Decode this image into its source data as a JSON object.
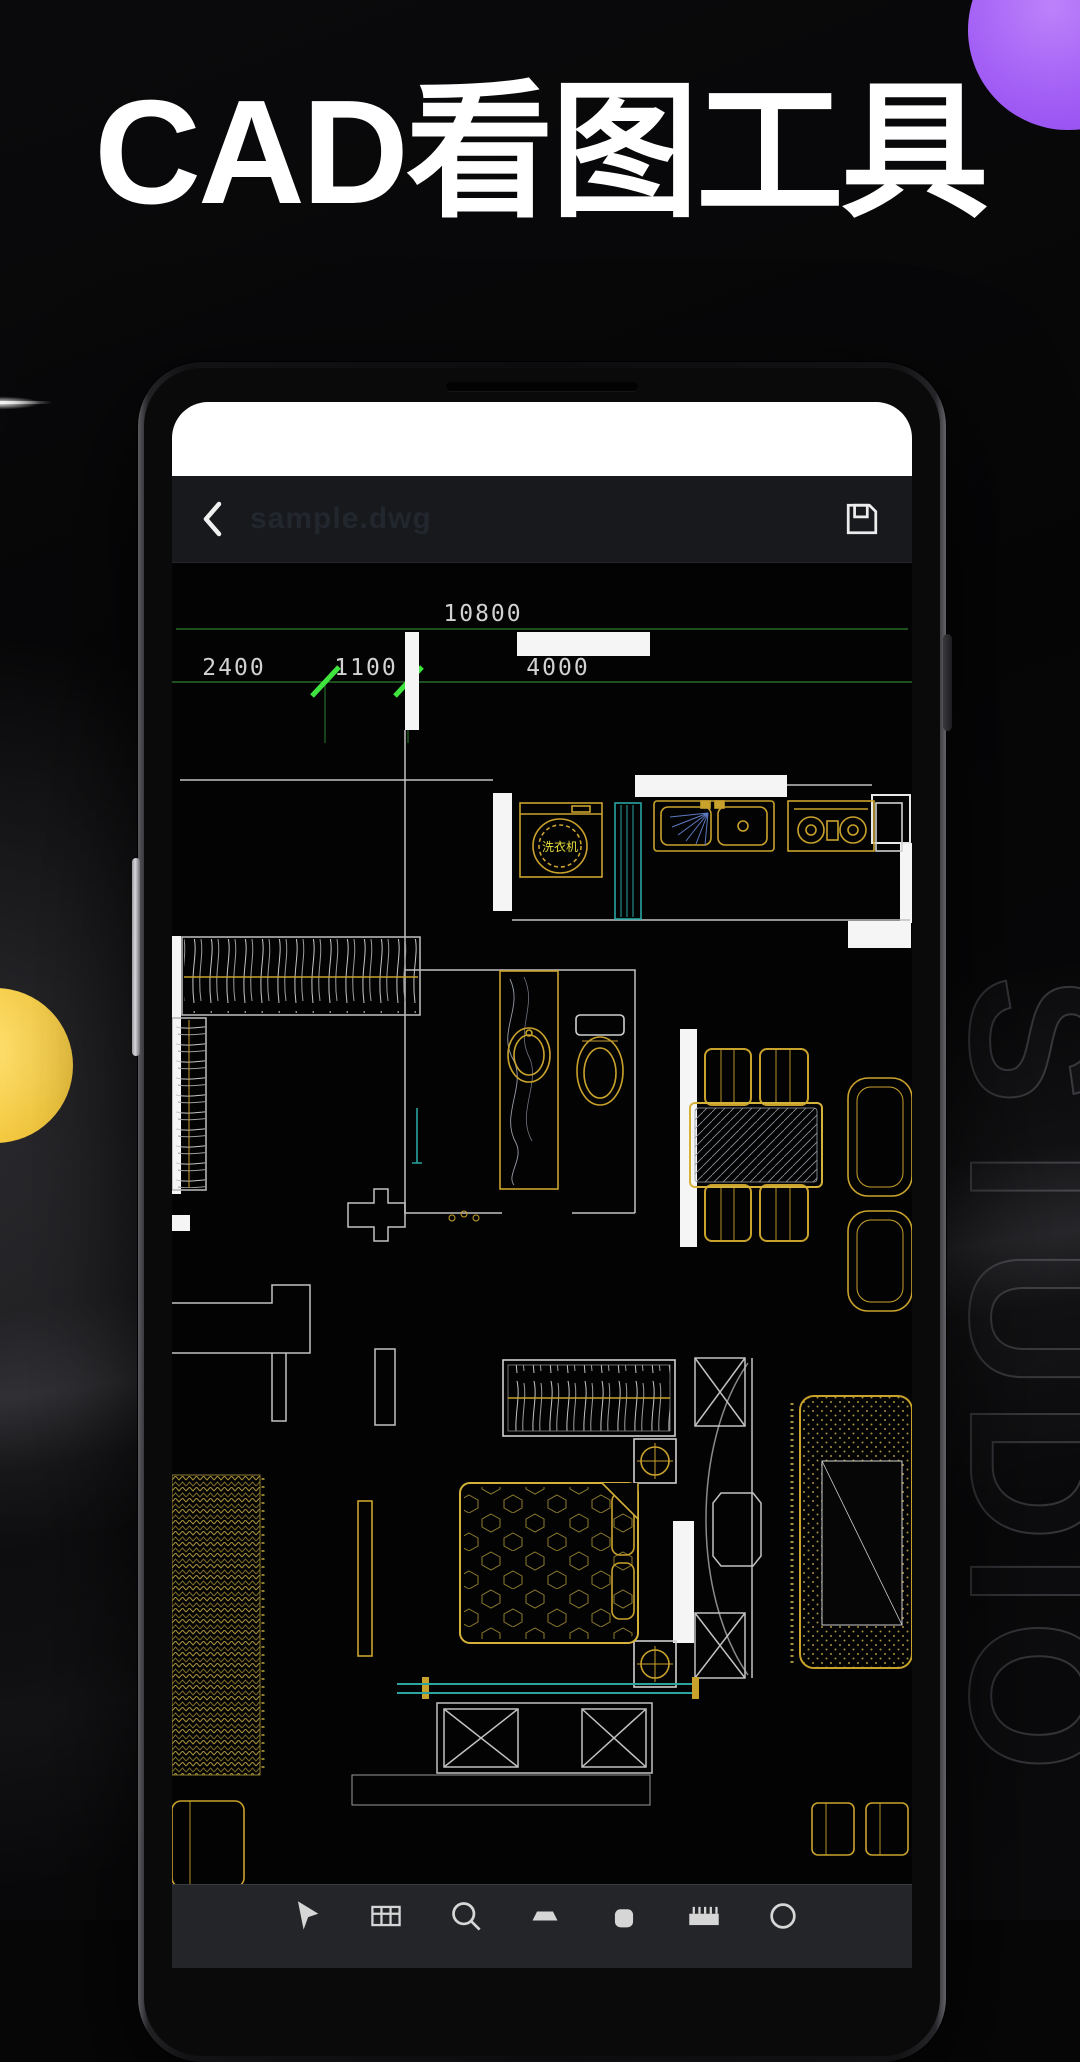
{
  "poster": {
    "title": "CAD看图工具",
    "watermark": "STUDIO"
  },
  "colors": {
    "background": "#070708",
    "accent_purple": "#a25ef5",
    "accent_yellow": "#f4c93e",
    "wall_white": "#f5f5f5",
    "furniture_gold": "#c9a22c",
    "dimension_green": "#2e7d2e",
    "tick_green": "#3fe43f",
    "fixture_cyan": "#2aa5a0",
    "dimension_text": "#d2d2d2"
  },
  "viewer": {
    "back_icon": "chevron-left",
    "filename": "sample.dwg",
    "save_icon": "floppy-disk"
  },
  "cad": {
    "dimensions": {
      "total": "10800",
      "segments": [
        "2400",
        "1100",
        "4000"
      ]
    },
    "labels": {
      "washing_machine": "洗衣机"
    }
  },
  "toolbar": {
    "icons": [
      "select",
      "layers",
      "zoom",
      "measure",
      "fill",
      "ruler",
      "circle"
    ]
  }
}
